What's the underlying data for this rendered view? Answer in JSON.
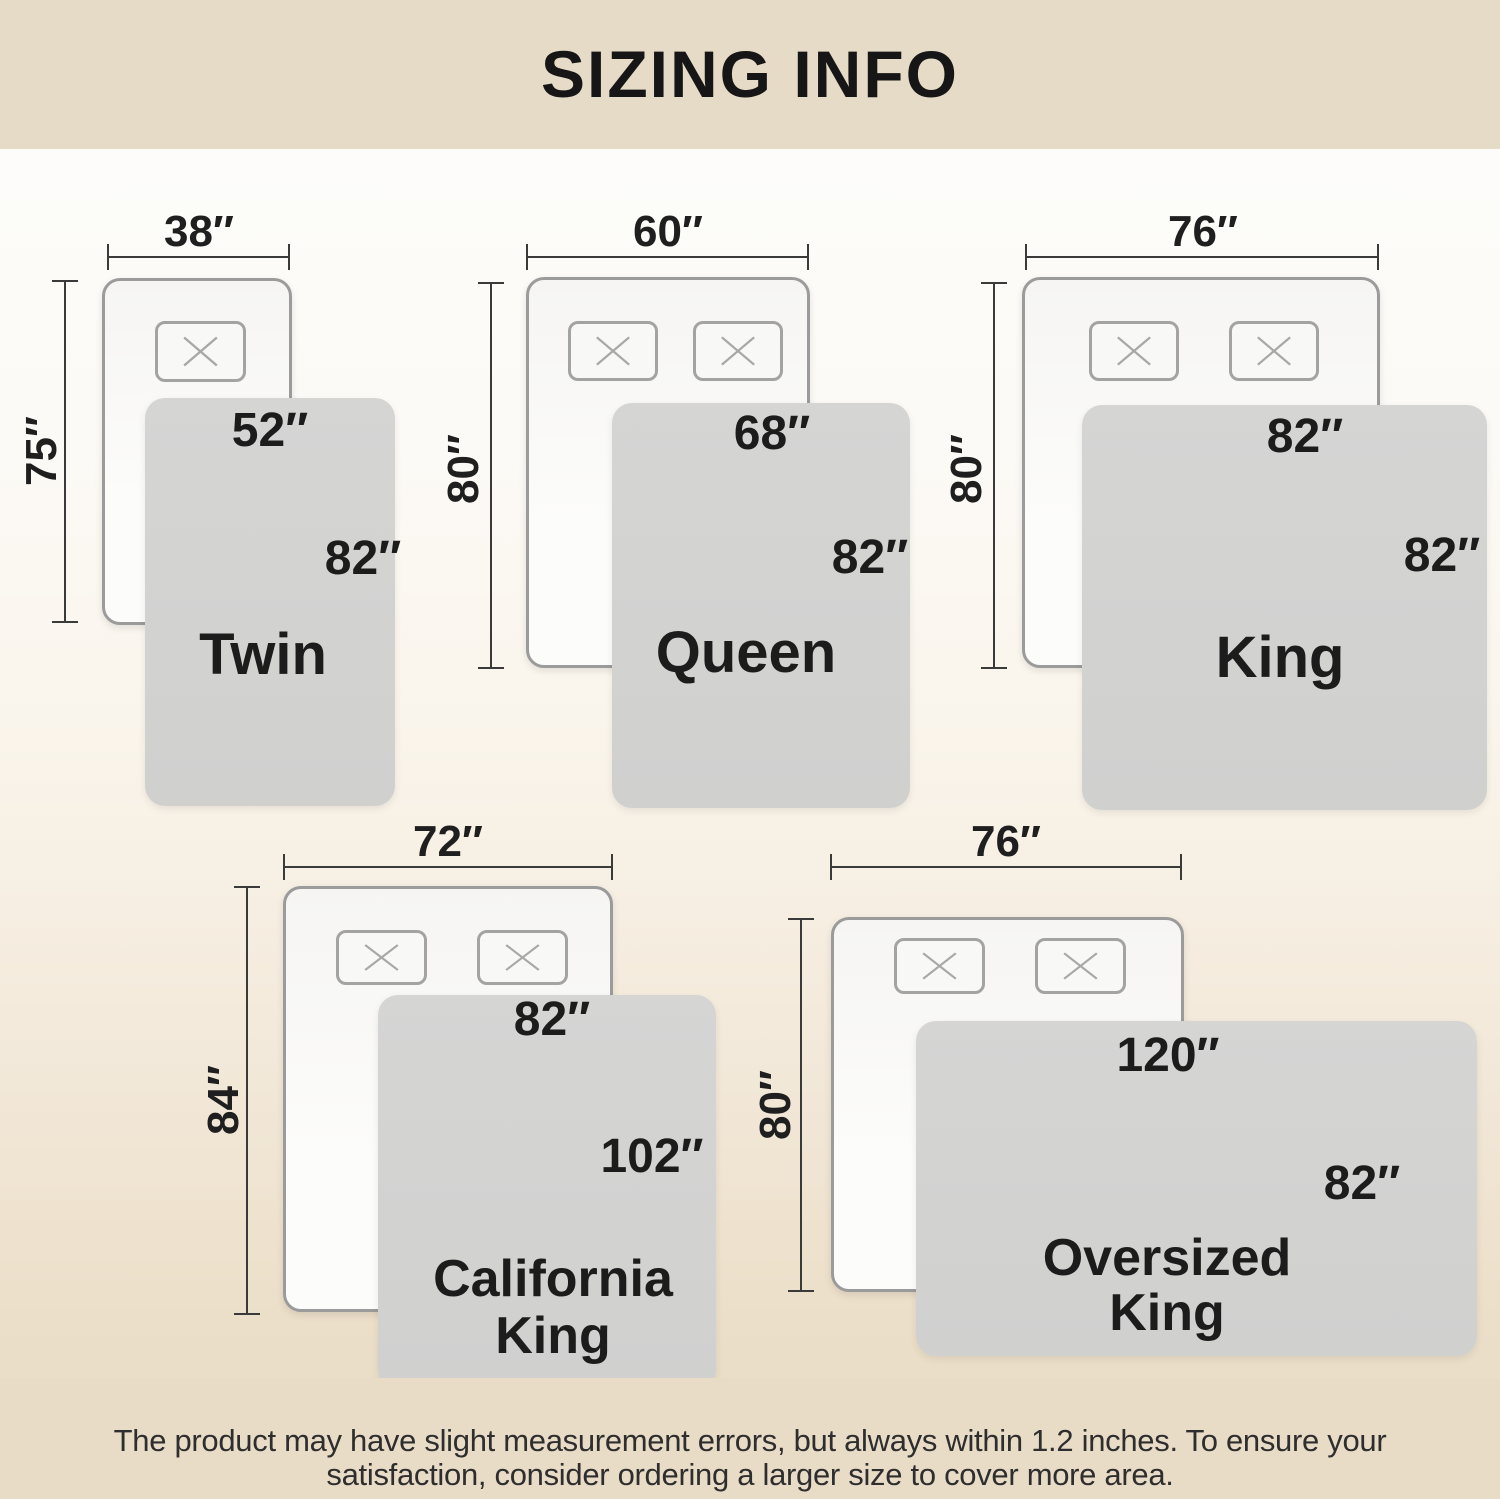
{
  "page": {
    "title": "SIZING INFO"
  },
  "disclaimer": {
    "line1": "The product may have slight measurement errors, but always within 1.2 inches. To ensure your",
    "line2": "satisfaction, consider ordering a larger size to cover more area."
  },
  "colors": {
    "band": "#e5dbc7",
    "blanket": "#d2d2d1",
    "mattress_border": "#9b9b9b",
    "text": "#1c1c1c"
  },
  "sizes": [
    {
      "name": "Twin",
      "bed_width": "38″",
      "bed_height": "75″",
      "blanket_width": "52″",
      "blanket_height": "82″",
      "name_lines": [
        "Twin"
      ],
      "pillow_count": 1
    },
    {
      "name": "Queen",
      "bed_width": "60″",
      "bed_height": "80″",
      "blanket_width": "68″",
      "blanket_height": "82″",
      "name_lines": [
        "Queen"
      ],
      "pillow_count": 2
    },
    {
      "name": "King",
      "bed_width": "76″",
      "bed_height": "80″",
      "blanket_width": "82″",
      "blanket_height": "82″",
      "name_lines": [
        "King"
      ],
      "pillow_count": 2
    },
    {
      "name": "California King",
      "bed_width": "72″",
      "bed_height": "84″",
      "blanket_width": "82″",
      "blanket_height": "102″",
      "name_lines": [
        "California",
        "King"
      ],
      "pillow_count": 2
    },
    {
      "name": "Oversized King",
      "bed_width": "76″",
      "bed_height": "80″",
      "blanket_width": "120″",
      "blanket_height": "82″",
      "name_lines": [
        "Oversized",
        "King"
      ],
      "pillow_count": 2
    }
  ]
}
